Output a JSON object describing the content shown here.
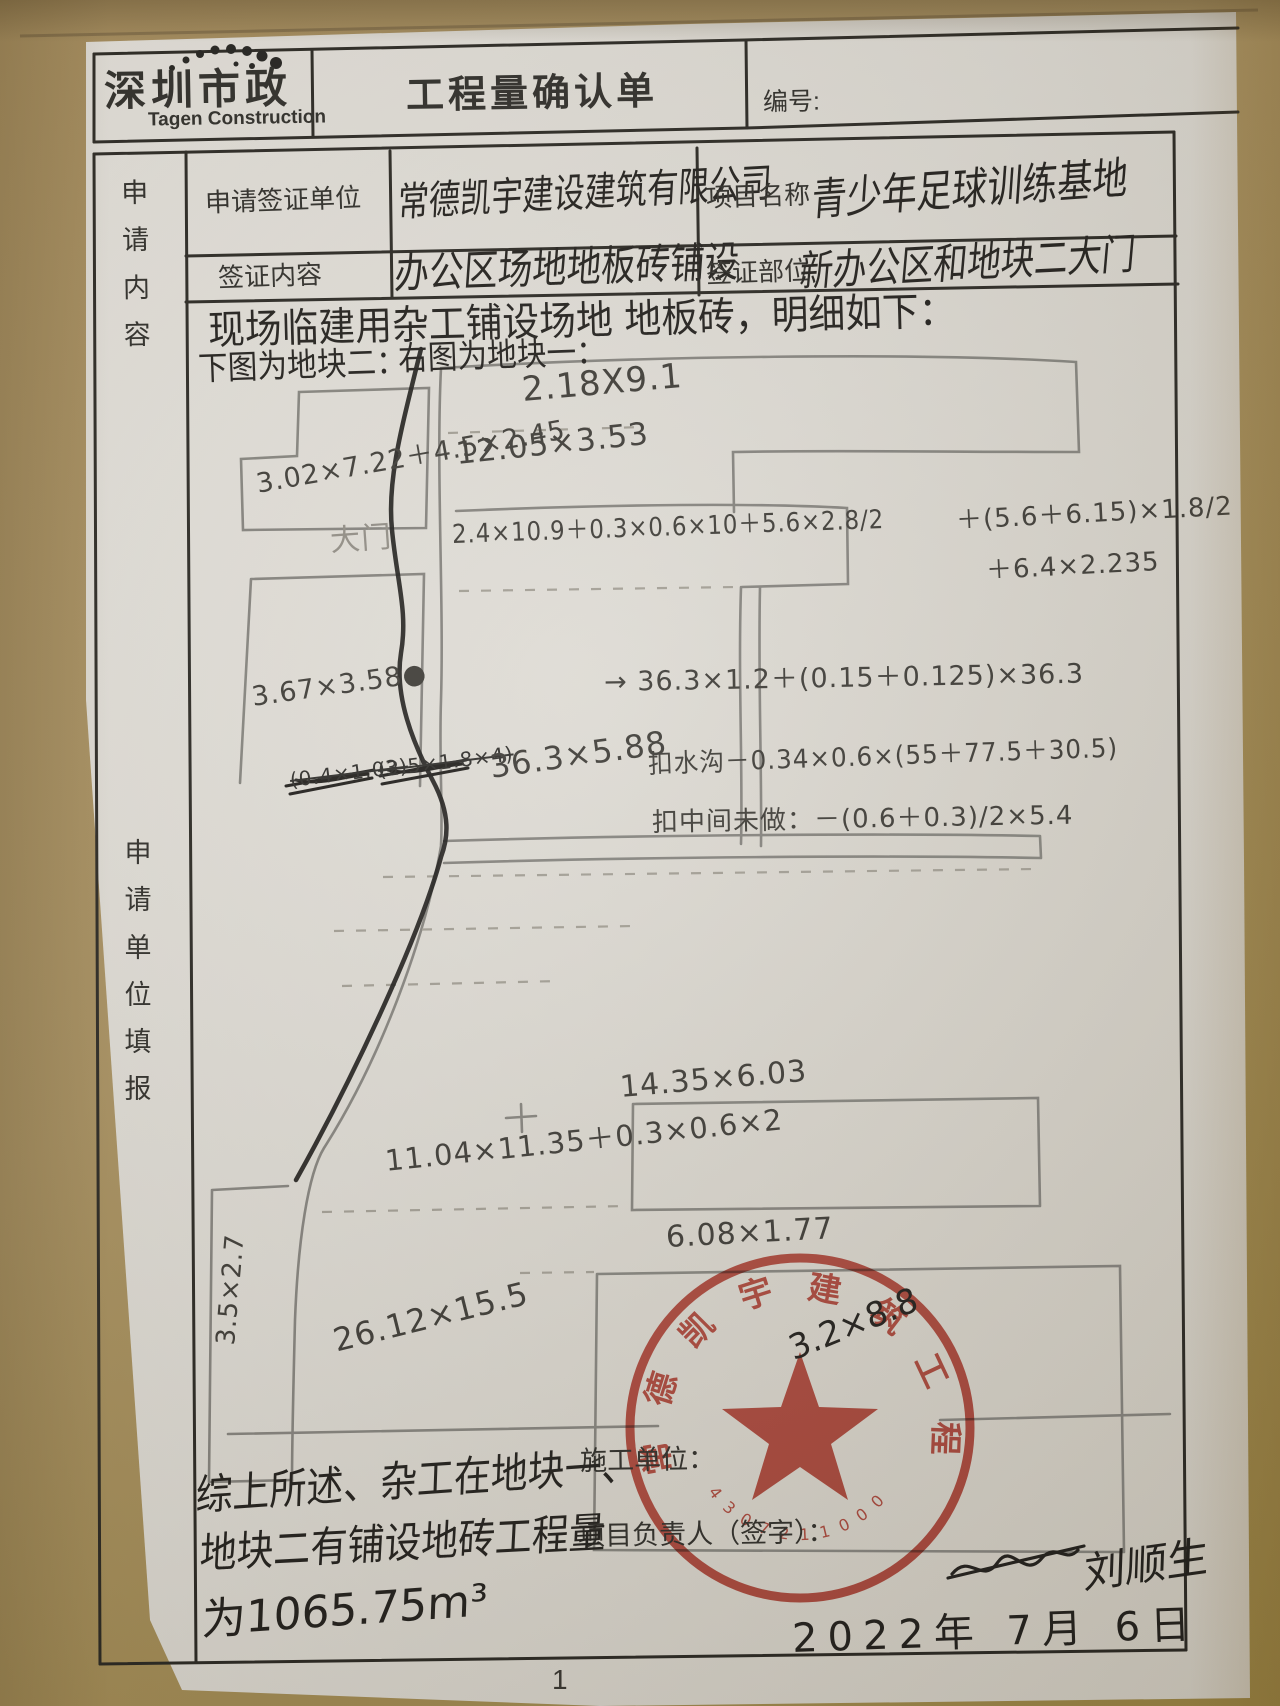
{
  "header": {
    "logo_cn": "深圳市政",
    "logo_en": "Tagen Construction",
    "title": "工程量确认单",
    "number_label": "编号:"
  },
  "form": {
    "left_label_top": "申请内容",
    "left_label_main": "申请单位填报",
    "rows": [
      {
        "label": "申请签证单位",
        "value": "常德凯宇建设建筑有限公司",
        "label2": "项目名称",
        "value2": "青少年足球训练基地"
      },
      {
        "label": "签证内容",
        "value": "办公区场地地板砖铺设",
        "label2": "签证部位",
        "value2": "新办公区和地块二大门"
      }
    ]
  },
  "content": {
    "intro": "现场临建用杂工铺设场地 地板砖，明细如下：",
    "sub_left": "下图为地块二：",
    "sub_right": "右图为地块一：",
    "labels": [
      {
        "t": "2.18X9.1",
        "x": 522,
        "y": 370,
        "r": -5,
        "s": 34
      },
      {
        "t": "12.05×3.53",
        "x": 456,
        "y": 436,
        "r": -6,
        "s": 31
      },
      {
        "t": "2.4×10.9＋0.3×0.6×10＋5.6×2.8/2",
        "x": 452,
        "y": 514,
        "r": -2,
        "s": 26,
        "cx": 0.88
      },
      {
        "t": "＋(5.6＋6.15)×1.8/2",
        "x": 956,
        "y": 500,
        "r": -3,
        "s": 26
      },
      {
        "t": "＋6.4×2.235",
        "x": 986,
        "y": 550,
        "r": -3,
        "s": 26
      },
      {
        "t": "3.02×7.22＋4.5×2.45",
        "x": 256,
        "y": 462,
        "r": -10,
        "s": 27
      },
      {
        "t": "大门",
        "x": 330,
        "y": 516,
        "r": -4,
        "s": 30,
        "light": true
      },
      {
        "t": "3.67×3.58●",
        "x": 252,
        "y": 682,
        "r": -8,
        "s": 27
      },
      {
        "t": "(0.4×1.03)",
        "x": 290,
        "y": 768,
        "r": -7,
        "s": 20,
        "struck": true
      },
      {
        "t": "(2.5×1.8×4)",
        "x": 378,
        "y": 758,
        "r": -7,
        "s": 20,
        "struck": true
      },
      {
        "t": "36.3×5.88",
        "x": 490,
        "y": 748,
        "r": -8,
        "s": 32
      },
      {
        "t": "→ 36.3×1.2＋(0.15＋0.125)×36.3",
        "x": 604,
        "y": 660,
        "r": -1,
        "s": 27
      },
      {
        "t": "扣水沟－0.34×0.6×(55＋77.5＋30.5)",
        "x": 648,
        "y": 744,
        "r": -2,
        "s": 26,
        "cx": 0.95
      },
      {
        "t": "扣中间未做：－(0.6＋0.3)/2×5.4",
        "x": 652,
        "y": 802,
        "r": -1,
        "s": 26
      },
      {
        "t": "14.35×6.03",
        "x": 620,
        "y": 1070,
        "r": -5,
        "s": 30
      },
      {
        "t": "11.04×11.35＋0.3×0.6×2",
        "x": 385,
        "y": 1138,
        "r": -6,
        "s": 29
      },
      {
        "t": "6.08×1.77",
        "x": 666,
        "y": 1220,
        "r": -3,
        "s": 30
      },
      {
        "t": "26.12×15.5",
        "x": 334,
        "y": 1322,
        "r": -14,
        "s": 32
      },
      {
        "t": "3.5×2.7",
        "x": 226,
        "y": 1330,
        "r": -85,
        "s": 26
      }
    ]
  },
  "footer": {
    "construction_unit_label": "施工单位：",
    "manager_label": "项目负责人（签字）：",
    "summary_line1": "综上所述、杂工在地块一、",
    "summary_line2": "地块二有铺设地砖工程量",
    "summary_line3": "为1065.75m³",
    "stamp_overwrite": "3.2×8.8",
    "signature": "刘顺生",
    "date": "2022年 7月 6日",
    "page_number": "1"
  },
  "stamp": {
    "company": "常德凯宇建筑工程有限公司",
    "serial": "43072110000690"
  },
  "colors": {
    "stamp_red": "#bf3527",
    "ink": "#1d1b18",
    "pencil": "#7b7974",
    "paper": "#ddd9d2"
  }
}
